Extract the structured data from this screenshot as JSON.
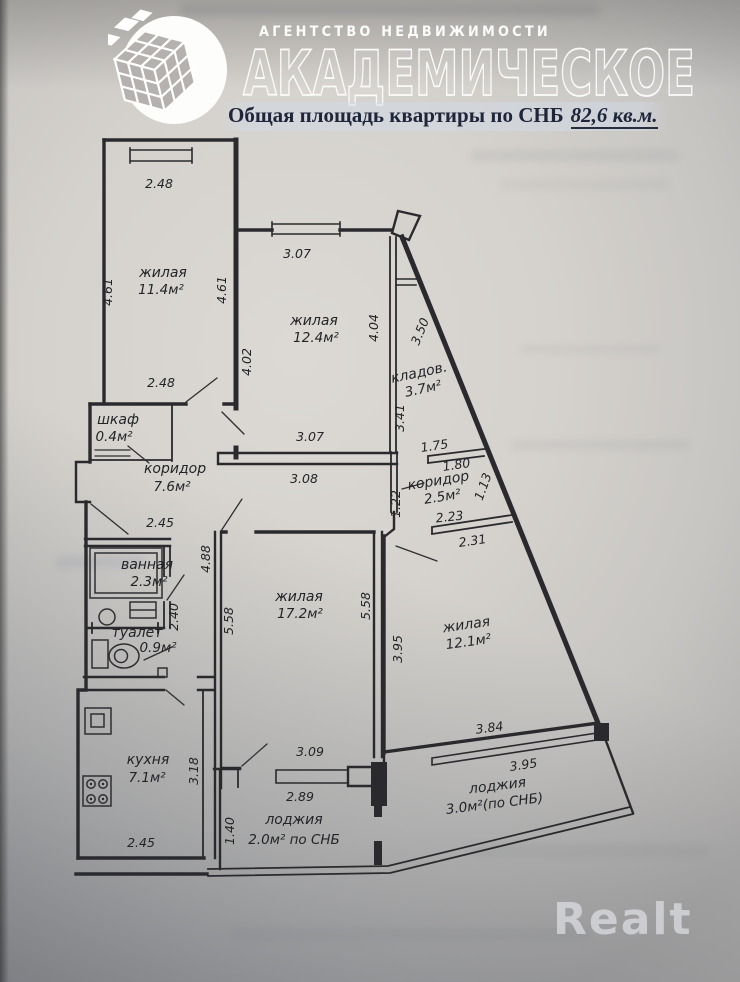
{
  "header": {
    "agency_tagline": "АГЕНТСТВО НЕДВИЖИМОСТИ",
    "agency_name": "АКАДЕМИЧЕСКОЕ",
    "area_label": "Общая площадь квартиры по СНБ",
    "area_value": "82,6 кв.м."
  },
  "plan": {
    "rooms": [
      {
        "name": "жилая",
        "area": "11.4м²"
      },
      {
        "name": "жилая",
        "area": "12.4м²"
      },
      {
        "name": "кладов.",
        "area": "3.7м²"
      },
      {
        "name": "шкаф",
        "area": "0.4м²"
      },
      {
        "name": "коридор",
        "area": "7.6м²"
      },
      {
        "name": "коридор",
        "area": "2.5м²"
      },
      {
        "name": "ванная",
        "area": "2.3м²"
      },
      {
        "name": "туалет",
        "area": "0.9м²"
      },
      {
        "name": "жилая",
        "area": "17.2м²"
      },
      {
        "name": "жилая",
        "area": "12.1м²"
      },
      {
        "name": "кухня",
        "area": "7.1м²"
      },
      {
        "name": "лоджия",
        "area": "2.0м² по СНБ"
      },
      {
        "name": "лоджия",
        "area": "3.0м²(по СНБ)"
      }
    ],
    "dims": [
      "2.48",
      "4.61",
      "4.61",
      "2.48",
      "3.07",
      "4.02",
      "4.04",
      "3.50",
      "3.41",
      "1.75",
      "1.80",
      "1.13",
      "1.22",
      "2.23",
      "2.31",
      "3.07",
      "3.08",
      "2.45",
      "4.88",
      "2.40",
      "5.58",
      "5.58",
      "3.95",
      "3.09",
      "3.84",
      "3.95",
      "2.89",
      "1.40",
      "2.45",
      "3.18"
    ]
  },
  "watermark": {
    "brand": "Realt"
  },
  "colors": {
    "ink": "#2a2a2e",
    "paper": "#d5d2cd",
    "title_text": "#20263a",
    "watermark": "#e9edf1"
  }
}
